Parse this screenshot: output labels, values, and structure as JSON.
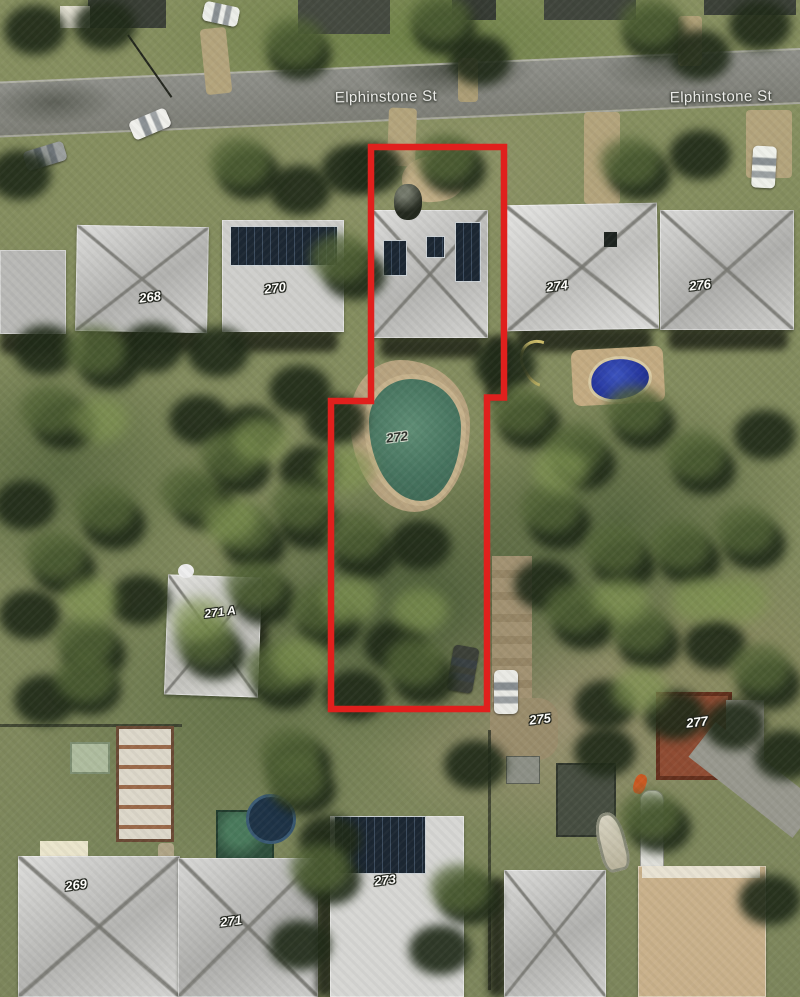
{
  "map": {
    "street_labels": [
      "Elphinstone St",
      "Elphinstone St"
    ],
    "lot_labels": {
      "268": "268",
      "270": "270",
      "272": "272",
      "274": "274",
      "276": "276",
      "271a": "271 A",
      "275": "275",
      "277": "277",
      "269": "269",
      "271": "271",
      "273": "273"
    },
    "highlight": {
      "color": "#e0201d"
    }
  }
}
